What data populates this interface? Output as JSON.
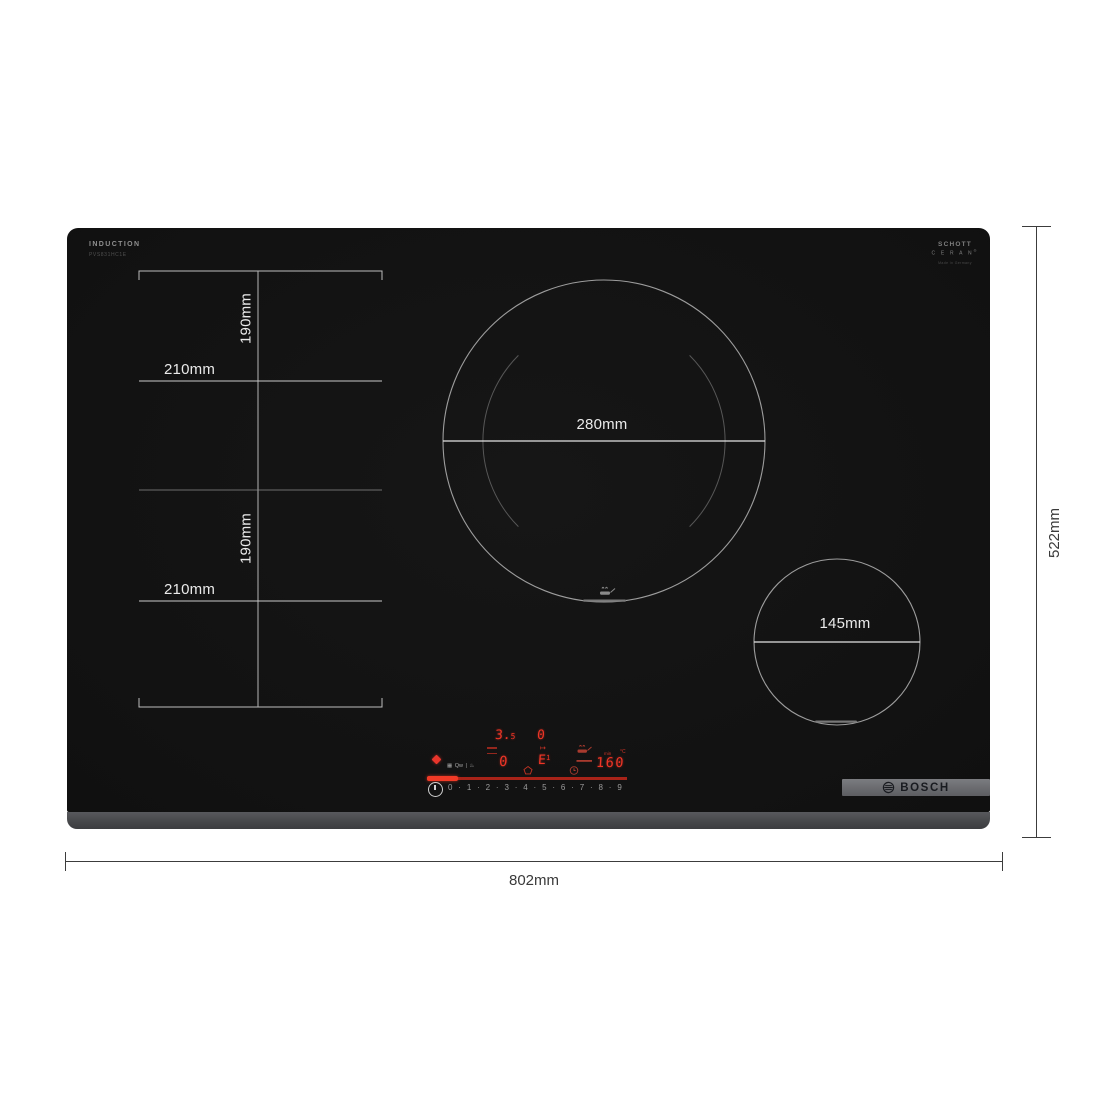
{
  "diagram": {
    "width_label": "802mm",
    "height_label": "522mm"
  },
  "cooktop": {
    "print": {
      "type_label": "INDUCTION",
      "model_label": "PVS831HC1E",
      "glass_brand_line1": "SCHOTT",
      "glass_brand_line2": "C E R A N",
      "glass_brand_reg": "®",
      "glass_brand_line3": "Made in Germany",
      "brand": "BOSCH"
    },
    "zones": {
      "flex_width_label": "210mm",
      "flex_height_label": "190mm",
      "large_diameter_label": "280mm",
      "small_diameter_label": "145mm"
    },
    "control_panel": {
      "power_display_main": "3.",
      "power_display_sub": "5",
      "aux_display": "0",
      "zone_display": "0",
      "fry_display_letter": "E",
      "fry_display_level": "1",
      "fry_arrow": "↦",
      "temp_display": "160",
      "unit_min": "min",
      "unit_celsius": "°C",
      "levels": [
        "0",
        "·",
        "1",
        "·",
        "2",
        "·",
        "3",
        "·",
        "4",
        "·",
        "5",
        "·",
        "6",
        "·",
        "7",
        "·",
        "8",
        "·",
        "9"
      ],
      "mini_icons": [
        "▦",
        "Qw",
        "|",
        "♨"
      ]
    },
    "colors": {
      "glass": "#131313",
      "trim": "#4a4b4e",
      "display_red": "#ee3526",
      "slider_red": "#a82318",
      "slider_red_bright": "#f03a26",
      "marking_white": "#eaeaea",
      "dimension_line": "#3c3c3c"
    }
  }
}
